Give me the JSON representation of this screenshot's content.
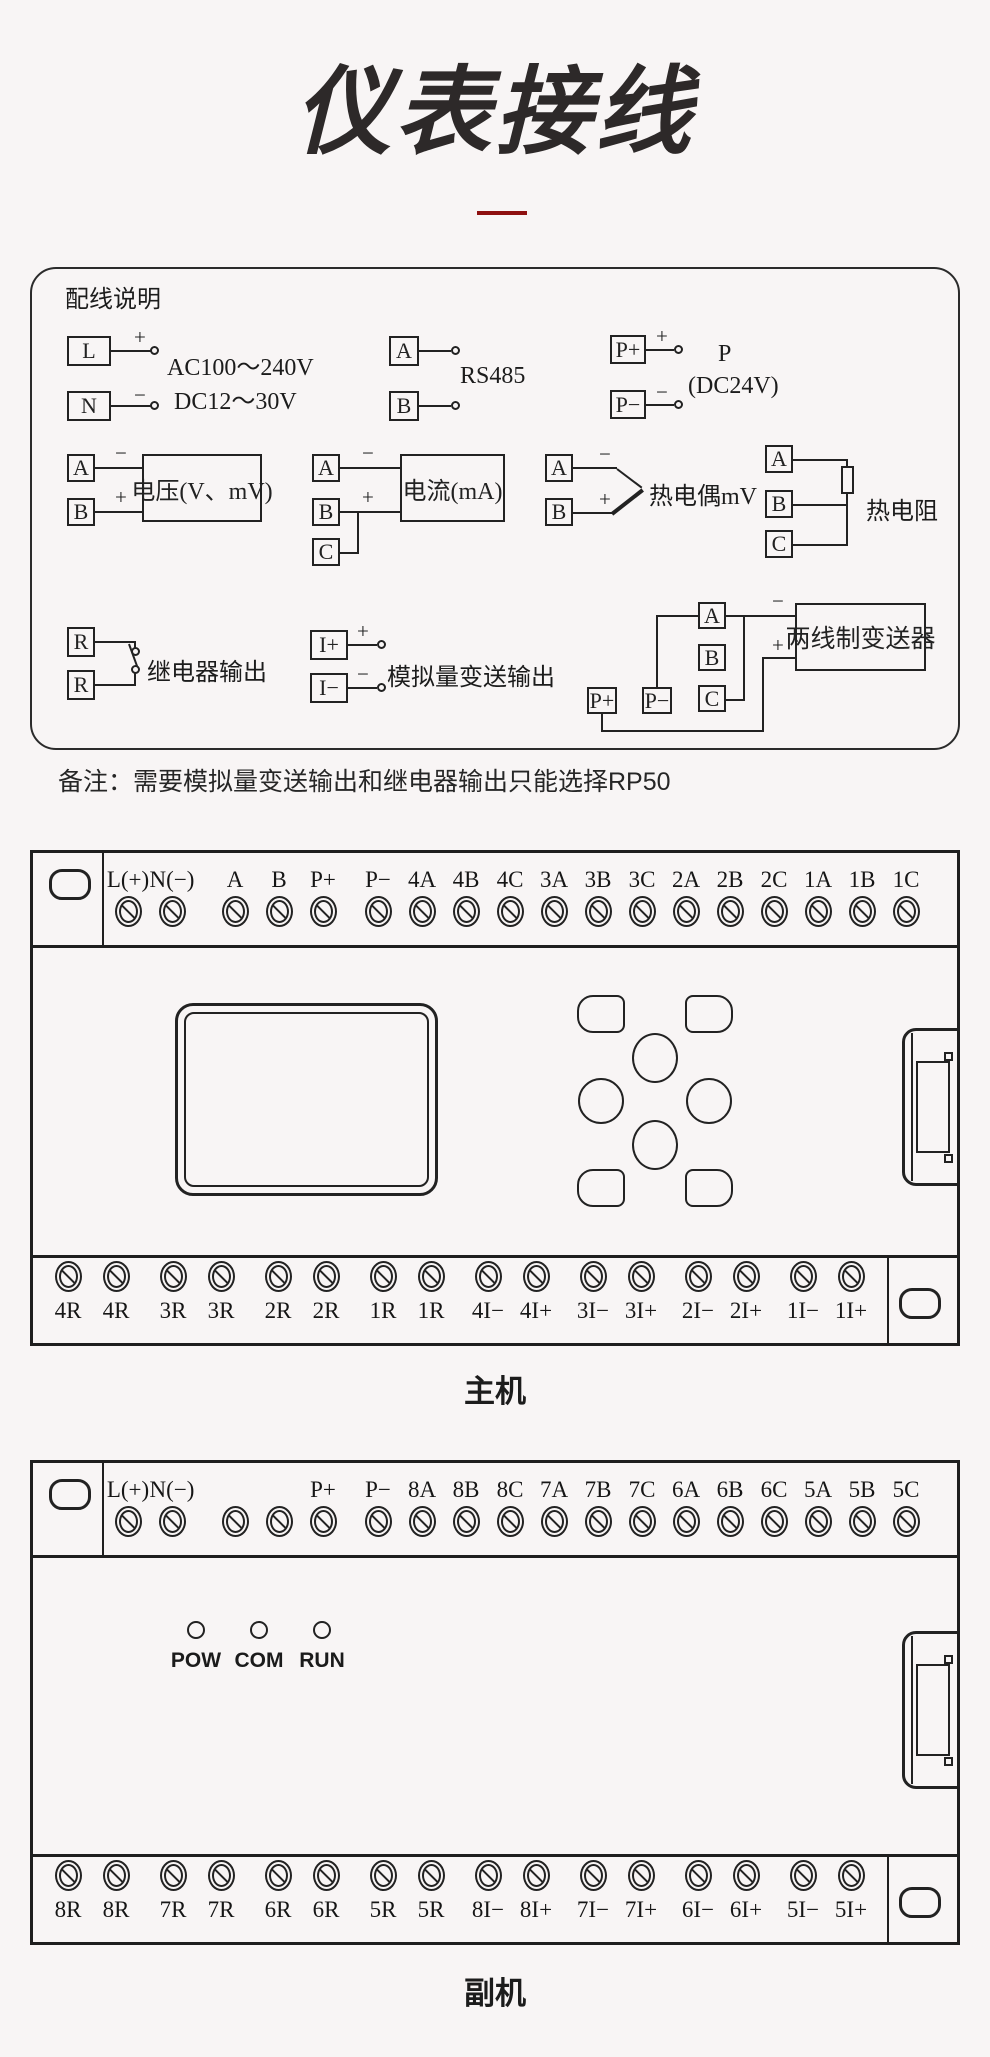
{
  "title": "仪表接线",
  "symbols": {
    "plus": "+",
    "minus": "−"
  },
  "wiring_box": {
    "heading": "配线说明",
    "power": {
      "t1": "L",
      "t2": "N",
      "line1": "AC100～240V",
      "line2": "DC12～30V"
    },
    "rs485": {
      "t1": "A",
      "t2": "B",
      "label": "RS485"
    },
    "power_out": {
      "t1": "P+",
      "t2": "P−",
      "line1": "P",
      "line2": "(DC24V)"
    },
    "voltage": {
      "t1": "A",
      "t2": "B",
      "label": "电压(V、mV)"
    },
    "current": {
      "t1": "A",
      "t2": "B",
      "t3": "C",
      "label": "电流(mA)"
    },
    "thermocouple": {
      "t1": "A",
      "t2": "B",
      "label": "热电偶mV"
    },
    "rtd": {
      "t1": "A",
      "t2": "B",
      "t3": "C",
      "label": "热电阻"
    },
    "relay": {
      "t1": "R",
      "t2": "R",
      "label": "继电器输出"
    },
    "analog_out": {
      "t1": "I+",
      "t2": "I−",
      "label": "模拟量变送输出"
    },
    "transmitter": {
      "tA": "A",
      "tB": "B",
      "tC": "C",
      "tPp": "P+",
      "tPm": "P−",
      "label": "两线制变送器"
    }
  },
  "note": "备注：需要模拟量变送输出和继电器输出只能选择RP50",
  "main_unit": {
    "name": "主机",
    "top_terminals": [
      "L(+)",
      "N(−)",
      "A",
      "B",
      "P+",
      "P−",
      "4A",
      "4B",
      "4C",
      "3A",
      "3B",
      "3C",
      "2A",
      "2B",
      "2C",
      "1A",
      "1B",
      "1C"
    ],
    "bottom_terminals": [
      "4R",
      "4R",
      "3R",
      "3R",
      "2R",
      "2R",
      "1R",
      "1R",
      "4I−",
      "4I+",
      "3I−",
      "3I+",
      "2I−",
      "2I+",
      "1I−",
      "1I+"
    ]
  },
  "sub_unit": {
    "name": "副机",
    "top_terminals": [
      "L(+)",
      "N(−)",
      "",
      "",
      "P+",
      "P−",
      "8A",
      "8B",
      "8C",
      "7A",
      "7B",
      "7C",
      "6A",
      "6B",
      "6C",
      "5A",
      "5B",
      "5C"
    ],
    "leds": [
      "POW",
      "COM",
      "RUN"
    ],
    "bottom_terminals": [
      "8R",
      "8R",
      "7R",
      "7R",
      "6R",
      "6R",
      "5R",
      "5R",
      "8I−",
      "8I+",
      "7I−",
      "7I+",
      "6I−",
      "6I+",
      "5I−",
      "5I+"
    ]
  }
}
